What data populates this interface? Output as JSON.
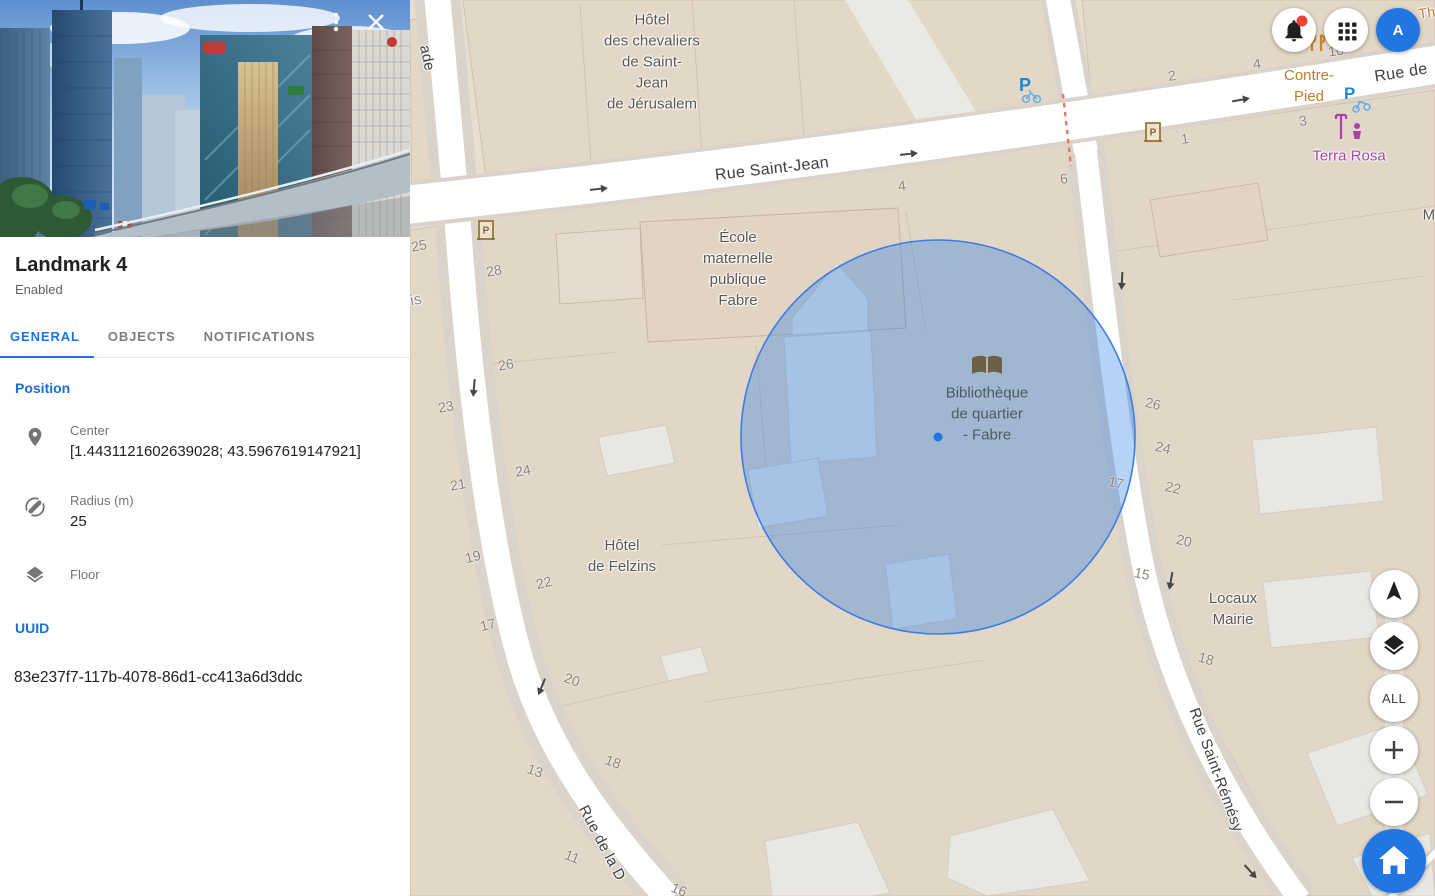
{
  "sidebar": {
    "title": "Landmark 4",
    "status": "Enabled",
    "tabs": [
      {
        "label": "GENERAL",
        "active": true
      },
      {
        "label": "OBJECTS",
        "active": false
      },
      {
        "label": "NOTIFICATIONS",
        "active": false
      }
    ],
    "position": {
      "heading": "Position",
      "center_label": "Center",
      "center_value": "[1.4431121602639028; 43.5967619147921]",
      "radius_label": "Radius (m)",
      "radius_value": "25",
      "floor_label": "Floor",
      "floor_value": ""
    },
    "uuid_heading": "UUID",
    "uuid_value": "83e237f7-117b-4078-86d1-cc413a6d3ddc",
    "icons": {
      "more": "vertical-ellipsis",
      "close": "x",
      "center": "map-pin",
      "radius": "circle-diameter",
      "floor": "layers"
    }
  },
  "topbar": {
    "avatar": {
      "letter": "A"
    },
    "notifications": {
      "has_badge": true,
      "badge_color": "#ea4335"
    },
    "icons": {
      "notifications": "bell",
      "apps": "grid-3x3"
    }
  },
  "map_controls": {
    "all_label": "ALL",
    "zoom_in": "+",
    "zoom_out": "−",
    "icons": {
      "compass": "navigation-arrow",
      "layers": "layers",
      "home": "house"
    }
  },
  "map": {
    "landmark_circle": {
      "center_x": 938,
      "center_y": 437,
      "radius": 197,
      "fill": "rgba(26,115,232,0.32)",
      "stroke": "#3b7de8"
    },
    "center_dot": {
      "x": 938,
      "y": 437,
      "color": "#2276e3"
    },
    "street_labels": [
      {
        "text": "Rue Saint-Jean",
        "x": 772,
        "y": 169,
        "rot": -6.5,
        "size": 16
      },
      {
        "text": "Rue de",
        "x": 1401,
        "y": 73,
        "rot": -9,
        "size": 16
      },
      {
        "text": "Rue Saint-Rémésy",
        "x": 1216,
        "y": 770,
        "rot": 70,
        "size": 15
      },
      {
        "text": "Rue de la D",
        "x": 602,
        "y": 843,
        "rot": 62,
        "size": 15
      },
      {
        "text": "ade",
        "x": 427,
        "y": 58,
        "rot": 78,
        "size": 15
      },
      {
        "text": "is",
        "x": 416,
        "y": 300,
        "rot": -10,
        "size": 15,
        "color": "#8b857c"
      },
      {
        "text": "M",
        "x": 1429,
        "y": 215,
        "rot": 0,
        "size": 15,
        "color": "#5d5953"
      },
      {
        "text": "Th",
        "x": 1427,
        "y": 13,
        "rot": -8,
        "size": 14,
        "color": "#bf7d2a"
      }
    ],
    "poi_labels": [
      {
        "name": "hotel-chevaliers",
        "lines": [
          "Hôtel",
          "des chevaliers",
          "de Saint-",
          "Jean",
          "de Jérusalem"
        ],
        "x": 652,
        "y": 62,
        "color": "#5d5850"
      },
      {
        "name": "ecole-maternelle",
        "lines": [
          "École",
          "maternelle",
          "publique",
          "Fabre"
        ],
        "x": 738,
        "y": 269,
        "color": "#5d5850"
      },
      {
        "name": "bibliotheque",
        "lines": [
          "Bibliothèque",
          "de quartier",
          "- Fabre"
        ],
        "x": 987,
        "y": 414,
        "color": "#4e5a63",
        "halo": false
      },
      {
        "name": "hotel-felzins",
        "lines": [
          "Hôtel",
          "de Felzins"
        ],
        "x": 622,
        "y": 556,
        "color": "#5d5850"
      },
      {
        "name": "locaux-mairie",
        "lines": [
          "Locaux",
          "Mairie"
        ],
        "x": 1233,
        "y": 609,
        "color": "#5d5850"
      },
      {
        "name": "contre-pied",
        "lines": [
          "Contre-",
          "Pied"
        ],
        "x": 1309,
        "y": 86,
        "color": "#bf7d2a"
      },
      {
        "name": "terra-rosa",
        "lines": [
          "Terra Rosa"
        ],
        "x": 1349,
        "y": 156,
        "color": "#a845a5"
      }
    ],
    "house_numbers": [
      {
        "t": "25",
        "x": 419,
        "y": 246,
        "rot": -10
      },
      {
        "t": "28",
        "x": 494,
        "y": 271,
        "rot": -10
      },
      {
        "t": "26",
        "x": 506,
        "y": 365,
        "rot": -10
      },
      {
        "t": "23",
        "x": 446,
        "y": 407,
        "rot": -10
      },
      {
        "t": "24",
        "x": 523,
        "y": 471,
        "rot": -10
      },
      {
        "t": "21",
        "x": 458,
        "y": 485,
        "rot": -10
      },
      {
        "t": "19",
        "x": 473,
        "y": 557,
        "rot": -14
      },
      {
        "t": "22",
        "x": 544,
        "y": 583,
        "rot": -14
      },
      {
        "t": "17",
        "x": 488,
        "y": 625,
        "rot": -14
      },
      {
        "t": "20",
        "x": 572,
        "y": 680,
        "rot": 20
      },
      {
        "t": "18",
        "x": 613,
        "y": 762,
        "rot": 20
      },
      {
        "t": "13",
        "x": 535,
        "y": 771,
        "rot": 20
      },
      {
        "t": "11",
        "x": 572,
        "y": 857,
        "rot": 22
      },
      {
        "t": "16",
        "x": 679,
        "y": 890,
        "rot": 22
      },
      {
        "t": "4",
        "x": 902,
        "y": 186,
        "rot": -7
      },
      {
        "t": "6",
        "x": 1064,
        "y": 179,
        "rot": -8
      },
      {
        "t": "2",
        "x": 1172,
        "y": 76,
        "rot": -8
      },
      {
        "t": "4",
        "x": 1257,
        "y": 64,
        "rot": -8
      },
      {
        "t": "1",
        "x": 1185,
        "y": 139,
        "rot": -8
      },
      {
        "t": "3",
        "x": 1303,
        "y": 121,
        "rot": -8
      },
      {
        "t": "10",
        "x": 1336,
        "y": 51,
        "rot": -8
      },
      {
        "t": "26",
        "x": 1153,
        "y": 404,
        "rot": 14
      },
      {
        "t": "24",
        "x": 1163,
        "y": 448,
        "rot": 14
      },
      {
        "t": "22",
        "x": 1173,
        "y": 488,
        "rot": 14
      },
      {
        "t": "17",
        "x": 1116,
        "y": 483,
        "rot": 12
      },
      {
        "t": "20",
        "x": 1184,
        "y": 541,
        "rot": 14
      },
      {
        "t": "15",
        "x": 1142,
        "y": 574,
        "rot": 12
      },
      {
        "t": "18",
        "x": 1206,
        "y": 659,
        "rot": 16
      }
    ],
    "map_icons": [
      "monument-icon",
      "monument-icon",
      "bicycle-parking-icon",
      "scooter-parking-icon",
      "restaurant-icon",
      "store-icon",
      "library-book-icon"
    ]
  },
  "colors": {
    "accent_blue": "#1a73e8",
    "map_background": "#e8ded0",
    "circle_fill": "rgba(26,115,232,0.32)",
    "avatar_bg": "#2276e3"
  }
}
